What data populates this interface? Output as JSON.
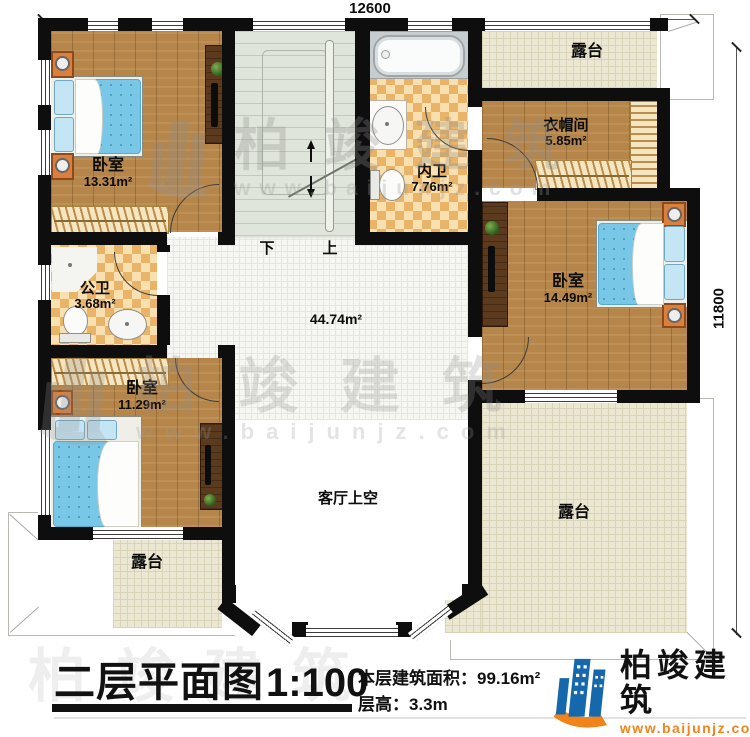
{
  "dims": {
    "width": "12600",
    "height": "11800"
  },
  "rooms": {
    "bedroom_tl": {
      "name": "卧室",
      "area": "13.31m²"
    },
    "inner_bath": {
      "name": "内卫",
      "area": "7.76m²"
    },
    "cloakroom": {
      "name": "衣帽间",
      "area": "5.85m²"
    },
    "bedroom_r": {
      "name": "卧室",
      "area": "14.49m²"
    },
    "public_bath": {
      "name": "公卫",
      "area": "3.68m²"
    },
    "bedroom_bl": {
      "name": "卧室",
      "area": "11.29m²"
    },
    "hall": {
      "area": "44.74m²"
    },
    "void": {
      "name": "客厅上空"
    },
    "terrace_tr": {
      "name": "露台"
    },
    "terrace_bl": {
      "name": "露台"
    },
    "terrace_br": {
      "name": "露台"
    }
  },
  "stairs": {
    "down_label": "下",
    "up_label": "上"
  },
  "footer": {
    "title": "二层平面图",
    "scale": "1:100",
    "area_label": "本层建筑面积：",
    "area_value": "99.16m²",
    "height_label": "层高：",
    "height_value": "3.3m"
  },
  "logo": {
    "name": "柏竣建筑",
    "site": "www.baijunjz.com"
  },
  "watermark": {
    "name": "柏竣建筑",
    "site": "www.baijunjz.com"
  },
  "colors": {
    "wall": "#0e0e0e",
    "wood_floor": "#b5854a",
    "dark_wood": "#5c3a1d",
    "bath_tile": "#e9b468",
    "terrace_tile": "#ebe7d3",
    "stair_floor": "#e0e5db",
    "bed_blue": "#79c7e6",
    "furniture_orange": "#d9803f",
    "logo_blue": "#1668ac",
    "logo_orange": "#f08419"
  }
}
